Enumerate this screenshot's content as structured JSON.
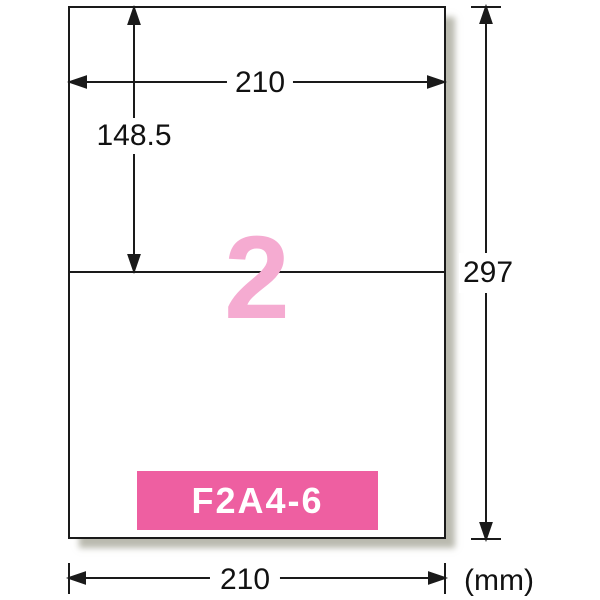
{
  "diagram": {
    "title": "label-sheet-dimension-diagram",
    "sheet": {
      "label_count": "2",
      "product_code": "F2A4-6"
    },
    "dimensions": {
      "width_top": "210",
      "half_height": "148.5",
      "height": "297",
      "width_bottom": "210",
      "unit": "(mm)"
    },
    "colors": {
      "banner_pink": "#ee5fa1",
      "count_pink": "#f5abd1",
      "line_black": "#1a1a1a"
    }
  }
}
